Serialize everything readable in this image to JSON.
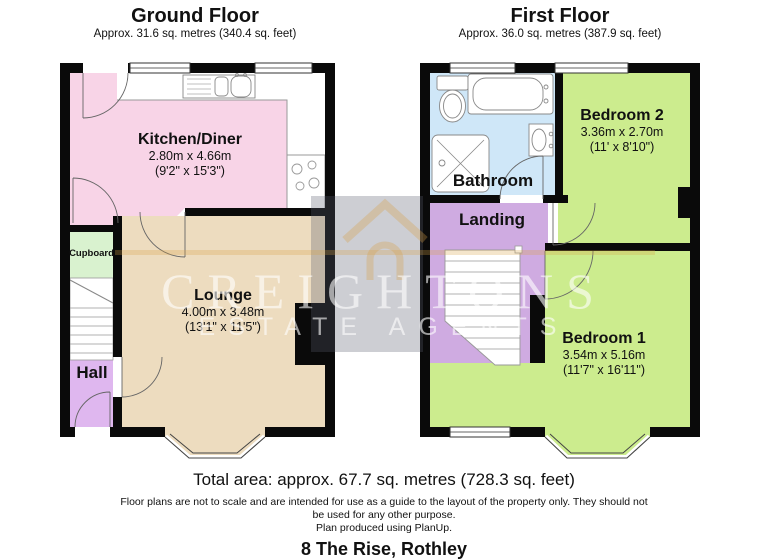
{
  "ground_floor": {
    "title": "Ground Floor",
    "subtitle": "Approx. 31.6 sq. metres (340.4 sq. feet)",
    "rooms": {
      "kitchen": {
        "name": "Kitchen/Diner",
        "dims_metric": "2.80m x 4.66m",
        "dims_imperial": "(9'2\" x 15'3\")",
        "color": "#f8d4e7"
      },
      "lounge": {
        "name": "Lounge",
        "dims_metric": "4.00m x 3.48m",
        "dims_imperial": "(13'1\" x 11'5\")",
        "color": "#eddcbf"
      },
      "cupboard": {
        "name": "Cupboard",
        "color": "#d9f2cf"
      },
      "hall": {
        "name": "Hall",
        "color": "#dfb7ef"
      }
    }
  },
  "first_floor": {
    "title": "First Floor",
    "subtitle": "Approx. 36.0 sq. metres (387.9 sq. feet)",
    "rooms": {
      "bathroom": {
        "name": "Bathroom",
        "color": "#cfe7f8"
      },
      "bedroom2": {
        "name": "Bedroom 2",
        "dims_metric": "3.36m x 2.70m",
        "dims_imperial": "(11' x 8'10\")",
        "color": "#ccec8e"
      },
      "landing": {
        "name": "Landing",
        "color": "#cfabe1"
      },
      "bedroom1": {
        "name": "Bedroom 1",
        "dims_metric": "3.54m x 5.16m",
        "dims_imperial": "(11'7\" x 16'11\")",
        "color": "#ccec8e"
      }
    }
  },
  "watermark": {
    "brand": "CREIGHTONS",
    "tagline": "ESTATE AGENTS",
    "icon": "house-icon",
    "band_color": "#5a5c6c",
    "gold_color": "#d6a046",
    "text_color": "#ffffff"
  },
  "footer": {
    "total_area": "Total area: approx. 67.7 sq. metres (728.3 sq. feet)",
    "disclaimer_line1": "Floor plans are not to scale and are intended for use as a guide to the layout of the property only. They should not",
    "disclaimer_line2": "be used for any other purpose.",
    "produced": "Plan produced using PlanUp.",
    "address": "8 The Rise, Rothley"
  },
  "colors": {
    "wall": "#0a0a0a",
    "stair": "#ffffff",
    "window": "#ffffff"
  }
}
